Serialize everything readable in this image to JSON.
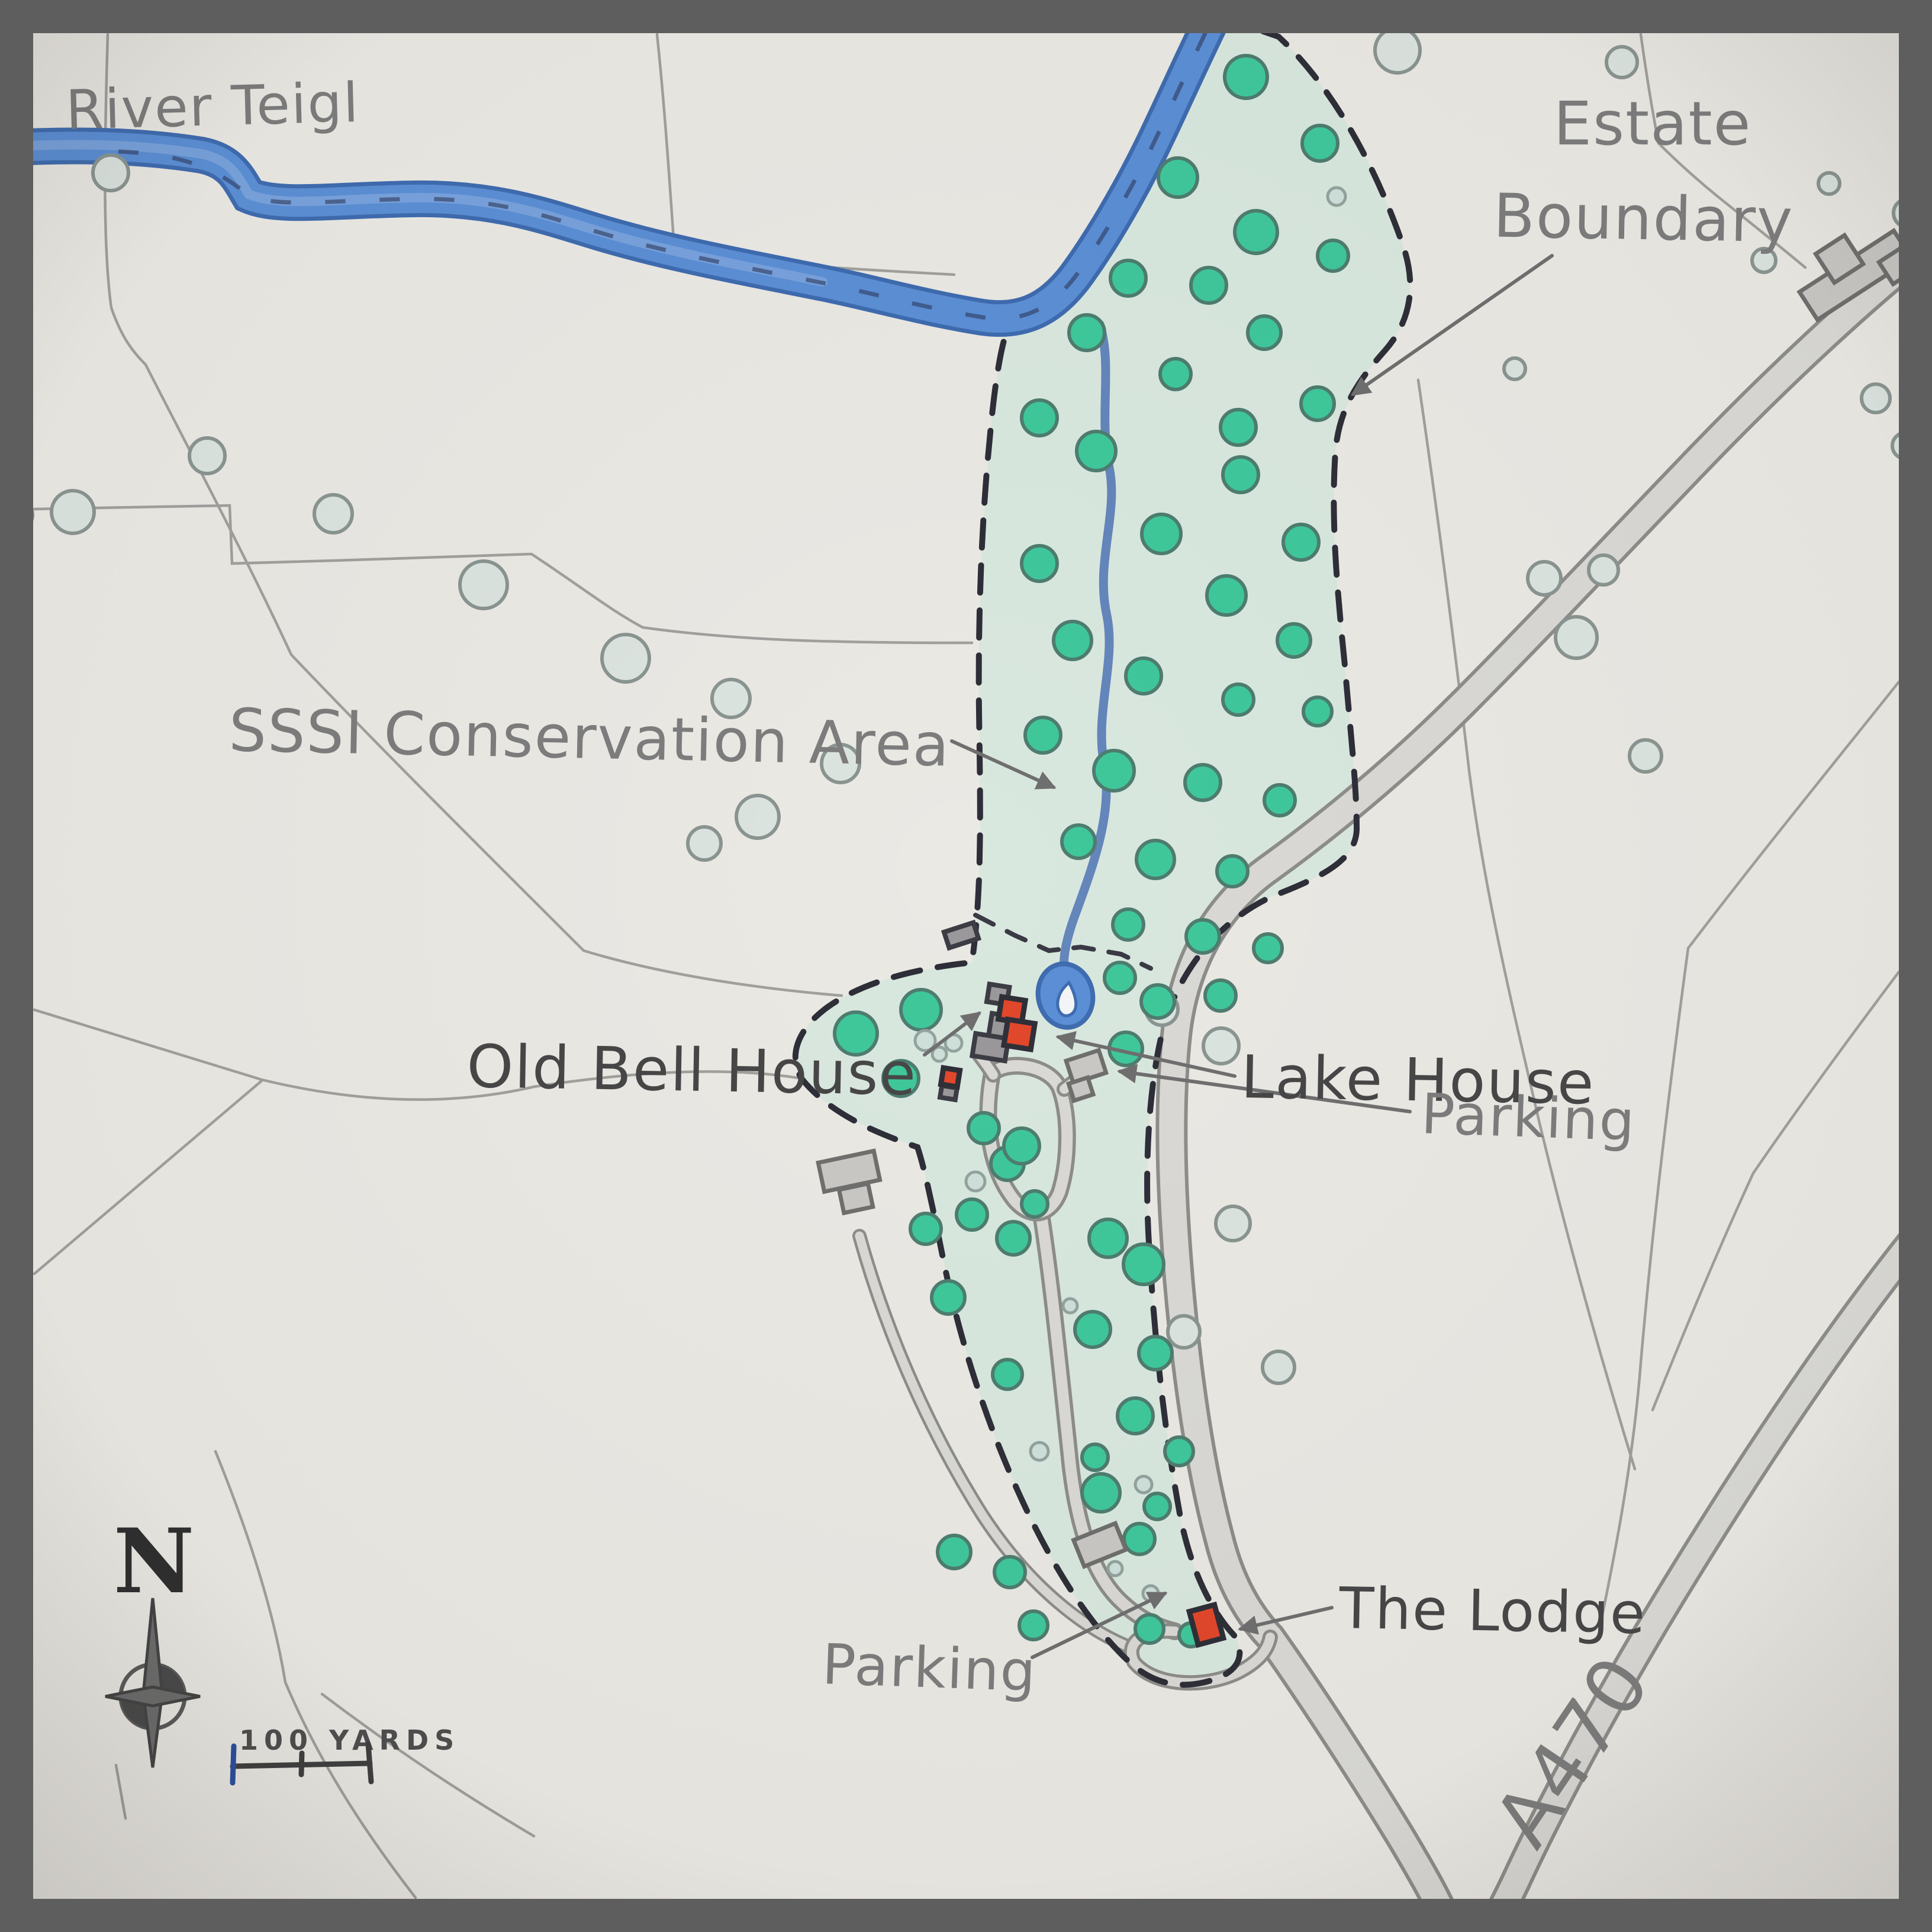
{
  "map": {
    "type": "hand-drawn estate map",
    "labels": {
      "river": "River Teigl",
      "estate_boundary_line1": "Estate",
      "estate_boundary_line2": "Boundary",
      "conservation_area": "SSSI Conservation Area",
      "old_bell_house": "Old Bell House",
      "lake_house": "Lake House",
      "parking_upper": "Parking",
      "parking_lower": "Parking",
      "the_lodge": "The Lodge",
      "road": "A470"
    },
    "compass_north": "N",
    "scale_bar": "100 YARDS",
    "colors": {
      "paper": "#ebe9e4",
      "frame": "#5e5e5e",
      "river": "#5b8fd6",
      "river_edge": "#3f6cb0",
      "estate": "#d7e7de",
      "tree": "#3fc89b",
      "tree_outside": "#dce4e0",
      "road_fill": "#dad9d5",
      "road_edge": "#8d8d8a",
      "building_red": "#e2472b",
      "building_gray": "#9a989b",
      "boundary": "#2e2e38",
      "label_dark": "#474747",
      "label_gray": "#7d7d7d",
      "field_line": "#a0a09d"
    },
    "trees": {
      "estate": [
        [
          2105,
          130,
          36
        ],
        [
          2230,
          242,
          30
        ],
        [
          1990,
          300,
          33
        ],
        [
          2122,
          392,
          36
        ],
        [
          2252,
          432,
          26
        ],
        [
          1906,
          470,
          30
        ],
        [
          2042,
          482,
          30
        ],
        [
          2136,
          562,
          28
        ],
        [
          1836,
          562,
          30
        ],
        [
          1986,
          632,
          26
        ],
        [
          2226,
          682,
          28
        ],
        [
          2092,
          722,
          30
        ],
        [
          1756,
          706,
          30
        ],
        [
          1852,
          762,
          33
        ],
        [
          2096,
          802,
          30
        ],
        [
          1962,
          902,
          33
        ],
        [
          2198,
          916,
          30
        ],
        [
          1756,
          952,
          30
        ],
        [
          2072,
          1006,
          33
        ],
        [
          2186,
          1082,
          28
        ],
        [
          1812,
          1082,
          32
        ],
        [
          1932,
          1142,
          30
        ],
        [
          2092,
          1182,
          26
        ],
        [
          2226,
          1202,
          24
        ],
        [
          1762,
          1242,
          30
        ],
        [
          1882,
          1302,
          34
        ],
        [
          2032,
          1322,
          30
        ],
        [
          2162,
          1352,
          26
        ],
        [
          1822,
          1422,
          28
        ],
        [
          1952,
          1452,
          32
        ],
        [
          2082,
          1472,
          26
        ],
        [
          1906,
          1562,
          26
        ],
        [
          2032,
          1582,
          28
        ],
        [
          2142,
          1602,
          24
        ],
        [
          1556,
          1706,
          34
        ],
        [
          1446,
          1746,
          36
        ],
        [
          1522,
          1822,
          30
        ],
        [
          1892,
          1652,
          26
        ],
        [
          1956,
          1692,
          28
        ],
        [
          2062,
          1682,
          26
        ],
        [
          1902,
          1772,
          28
        ],
        [
          1662,
          1906,
          26
        ],
        [
          1702,
          1966,
          28
        ],
        [
          1642,
          2052,
          26
        ],
        [
          1564,
          2076,
          26
        ],
        [
          1712,
          2092,
          28
        ],
        [
          1872,
          2092,
          32
        ],
        [
          1932,
          2136,
          34
        ],
        [
          1726,
          1936,
          30
        ],
        [
          1748,
          2034,
          22
        ],
        [
          1602,
          2192,
          28
        ],
        [
          1846,
          2246,
          30
        ],
        [
          1952,
          2286,
          28
        ],
        [
          1702,
          2322,
          25
        ],
        [
          1918,
          2392,
          30
        ],
        [
          1850,
          2462,
          22
        ],
        [
          1992,
          2452,
          24
        ],
        [
          1955,
          2545,
          22
        ],
        [
          1612,
          2622,
          28
        ],
        [
          1706,
          2656,
          26
        ],
        [
          1860,
          2522,
          32
        ],
        [
          1925,
          2600,
          26
        ],
        [
          1746,
          2746,
          24
        ],
        [
          1942,
          2752,
          24
        ],
        [
          2012,
          2762,
          20
        ]
      ],
      "outside": [
        [
          30,
          870,
          25
        ],
        [
          123,
          865,
          36
        ],
        [
          187,
          292,
          30
        ],
        [
          350,
          770,
          30
        ],
        [
          563,
          868,
          32
        ],
        [
          817,
          988,
          40
        ],
        [
          1057,
          1112,
          40
        ],
        [
          1235,
          1180,
          32
        ],
        [
          1190,
          1425,
          28
        ],
        [
          1280,
          1380,
          36
        ],
        [
          1420,
          1290,
          32
        ],
        [
          2361,
          85,
          38
        ],
        [
          2740,
          105,
          26
        ],
        [
          2980,
          440,
          20
        ],
        [
          3223,
          360,
          24
        ],
        [
          3090,
          310,
          18
        ],
        [
          2559,
          623,
          18
        ],
        [
          3169,
          673,
          24
        ],
        [
          3219,
          753,
          22
        ],
        [
          2609,
          977,
          28
        ],
        [
          2709,
          963,
          25
        ],
        [
          2663,
          1077,
          35
        ],
        [
          2780,
          1277,
          27
        ],
        [
          1963,
          1705,
          27
        ],
        [
          2063,
          1767,
          30
        ],
        [
          2083,
          2067,
          29
        ],
        [
          2000,
          2250,
          27
        ],
        [
          2160,
          2310,
          27
        ]
      ],
      "shrubs": [
        [
          1563,
          1758,
          17
        ],
        [
          1587,
          1781,
          12
        ],
        [
          1611,
          1762,
          14
        ],
        [
          1648,
          1996,
          16
        ],
        [
          1756,
          2452,
          15
        ],
        [
          1932,
          2508,
          14
        ],
        [
          1808,
          2206,
          12
        ],
        [
          1944,
          2692,
          13
        ],
        [
          2258,
          332,
          15
        ],
        [
          1884,
          2650,
          12
        ]
      ]
    }
  }
}
